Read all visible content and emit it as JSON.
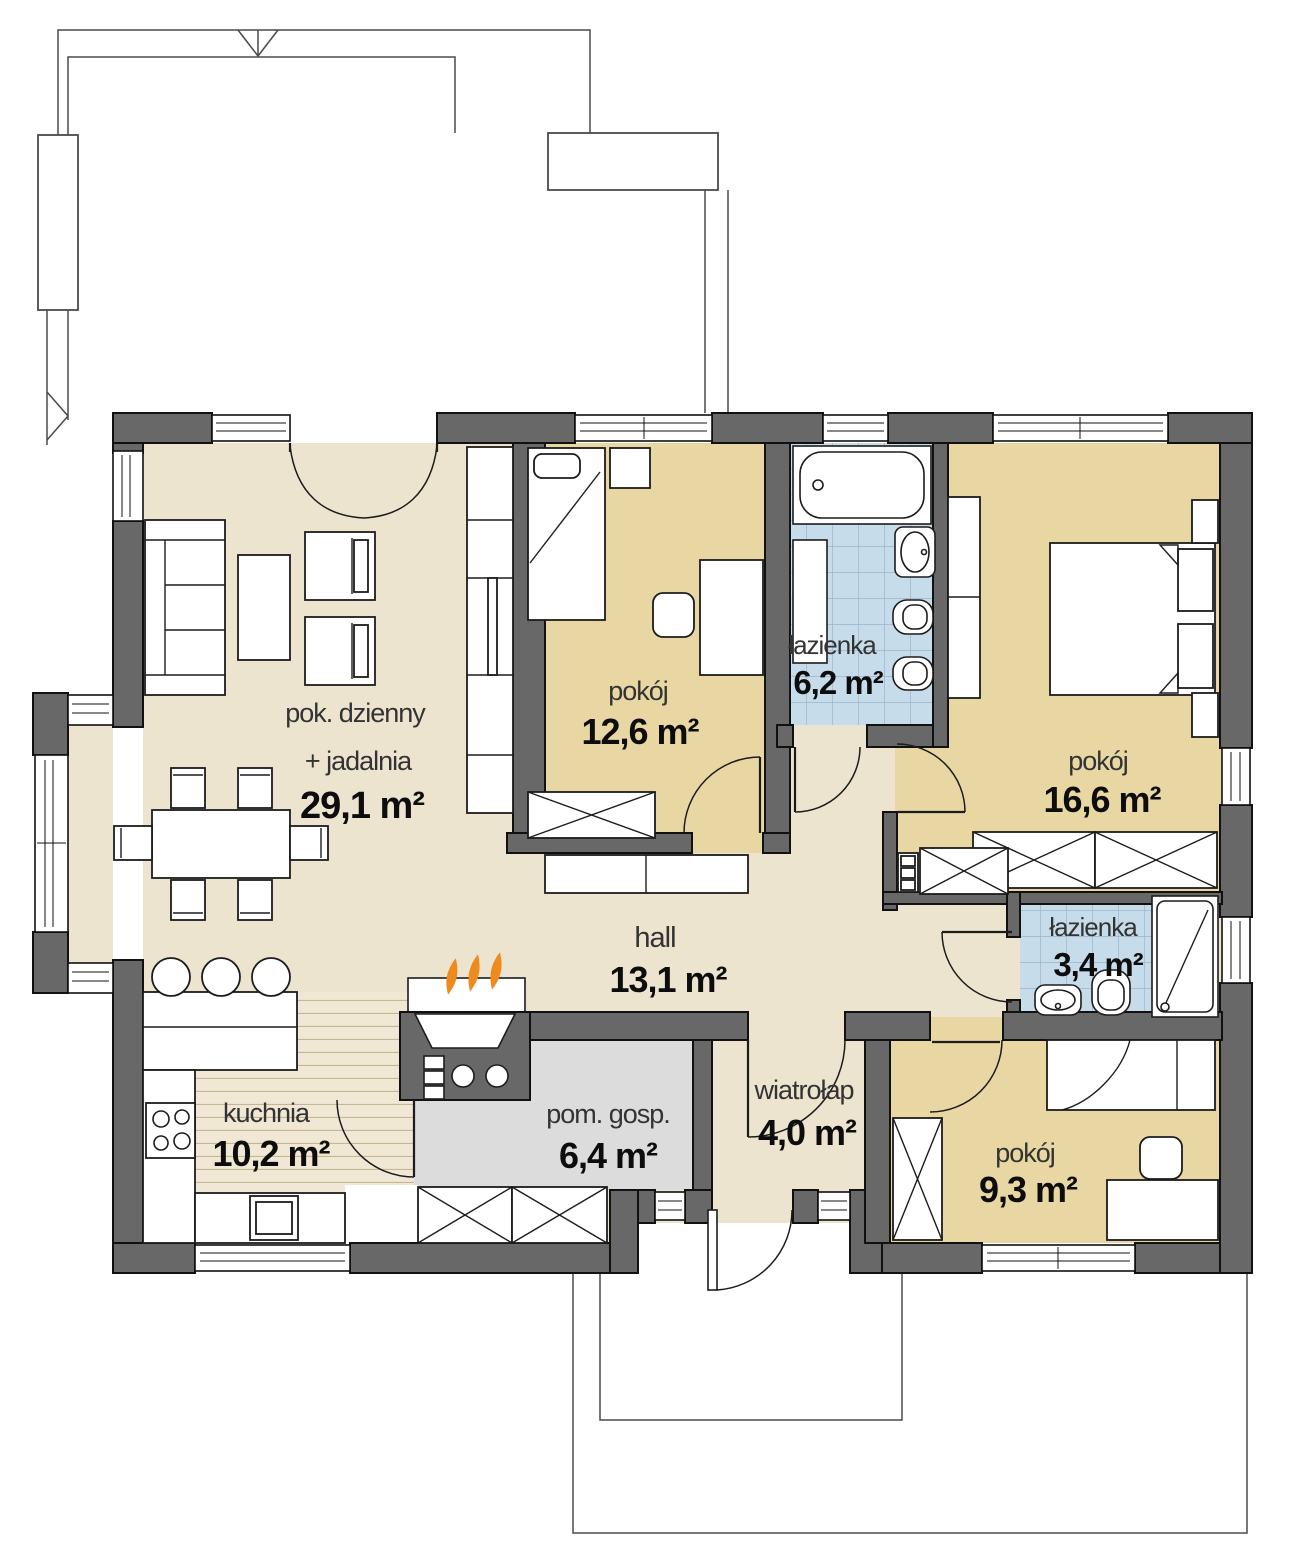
{
  "plan": {
    "type": "single-storey house floor plan",
    "rooms": [
      {
        "id": "living",
        "name": "pok. dzienny",
        "name2": "+ jadalnia",
        "area": "29,1 m²"
      },
      {
        "id": "room1",
        "name": "pokój",
        "area": "12,6 m²"
      },
      {
        "id": "bath1",
        "name": "łazienka",
        "area": "6,2 m²"
      },
      {
        "id": "room2",
        "name": "pokój",
        "area": "16,6 m²"
      },
      {
        "id": "hall",
        "name": "hall",
        "area": "13,1 m²"
      },
      {
        "id": "bath2",
        "name": "łazienka",
        "area": "3,4 m²"
      },
      {
        "id": "kitchen",
        "name": "kuchnia",
        "area": "10,2 m²"
      },
      {
        "id": "utility",
        "name": "pom. gosp.",
        "area": "6,4 m²"
      },
      {
        "id": "vestibule",
        "name": "wiatrołap",
        "area": "4,0 m²"
      },
      {
        "id": "room3",
        "name": "pokój",
        "area": "9,3 m²"
      }
    ]
  },
  "colors": {
    "wall": "#686868",
    "wall_stroke": "#111111",
    "line": "#1c1c1c",
    "outline": "#4a4a4a",
    "floor_main": "#ece4cf",
    "floor_room": "#e8d7a3",
    "floor_bath": "#c7dcea",
    "bath_grid": "#9db4c8",
    "floor_kitchen": "#f0e8d5",
    "kitchen_stripe": "#c3b794",
    "floor_utility": "#dcdcdc",
    "flame": "#ee8a1e"
  }
}
